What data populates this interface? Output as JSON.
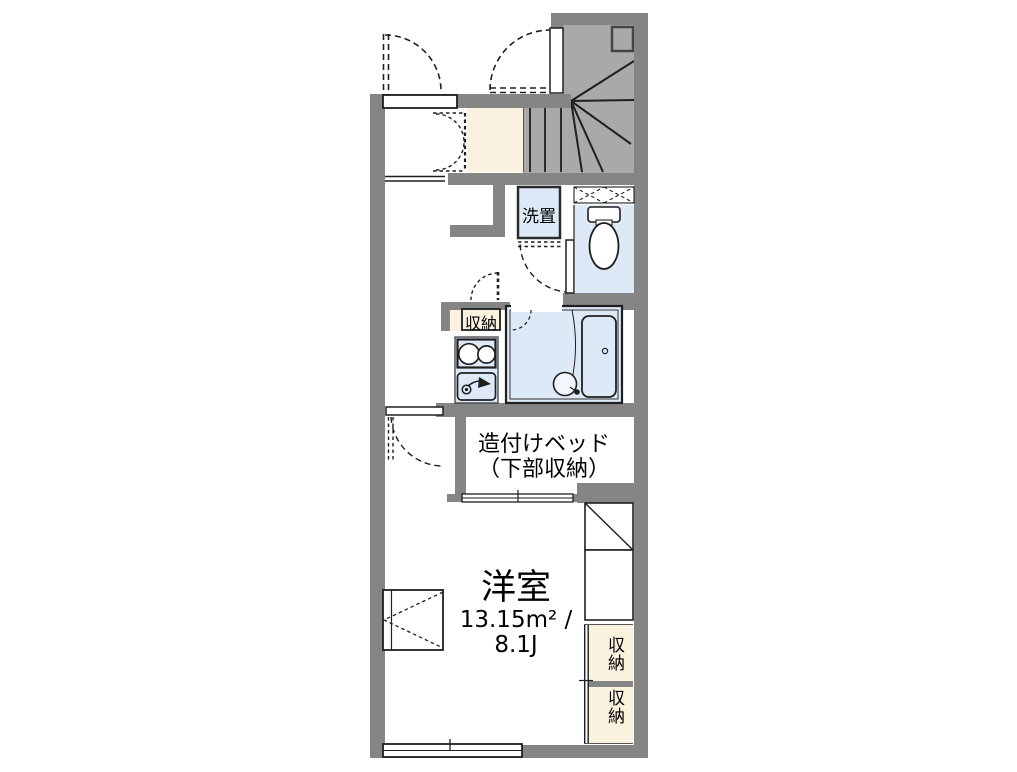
{
  "colors": {
    "wall": "#858585",
    "stair_fill": "#a9a9a9",
    "cream": "#fbf1df",
    "water_blue": "#dde9f6",
    "line": "#1f1f1f",
    "background": "#ffffff"
  },
  "labels": {
    "washer_place": "洗置",
    "hall_storage": "収納",
    "bed_line1": "造付けベッド",
    "bed_line2": "（下部収納）",
    "room_name": "洋室",
    "room_area_sqm": "13.15m² /",
    "room_area_tatami": "8.1J",
    "closet_upper": "収納",
    "closet_lower": "収納"
  }
}
